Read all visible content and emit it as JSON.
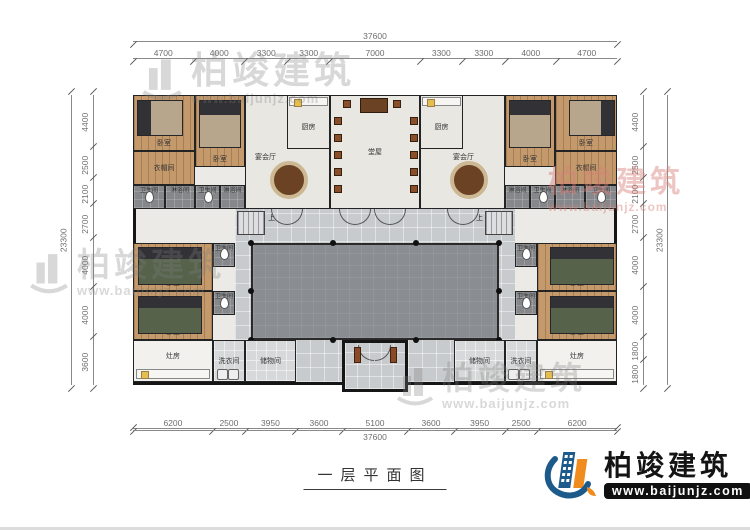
{
  "title": "一层平面图",
  "brand": {
    "name": "柏竣建筑",
    "url": "www.baijunjz.com"
  },
  "dimensions": {
    "top": {
      "total": "37600",
      "segments": [
        "4700",
        "4000",
        "3300",
        "3300",
        "7000",
        "3300",
        "3300",
        "4000",
        "4700"
      ]
    },
    "bottom": {
      "total": "37600",
      "segments": [
        "6200",
        "2500",
        "3950",
        "3600",
        "5100",
        "3600",
        "3950",
        "2500",
        "6200"
      ]
    },
    "left": {
      "total": "23300",
      "segments": [
        "4400",
        "2500",
        "2100",
        "2700",
        "4000",
        "4000",
        "3600"
      ]
    },
    "right": {
      "total": "23300",
      "segments": [
        "4400",
        "2500",
        "2100",
        "2700",
        "4000",
        "4000",
        "1800",
        "1800"
      ]
    }
  },
  "rooms": {
    "bedroom": "卧室",
    "cloakroom": "衣帽间",
    "toilet": "卫生间",
    "shower": "淋浴间",
    "banquet_hall": "宴会厅",
    "kitchen": "厨房",
    "main_hall": "堂屋",
    "stove_room": "灶房",
    "laundry": "洗衣间",
    "storage": "储物间",
    "stairs_up": "上"
  }
}
